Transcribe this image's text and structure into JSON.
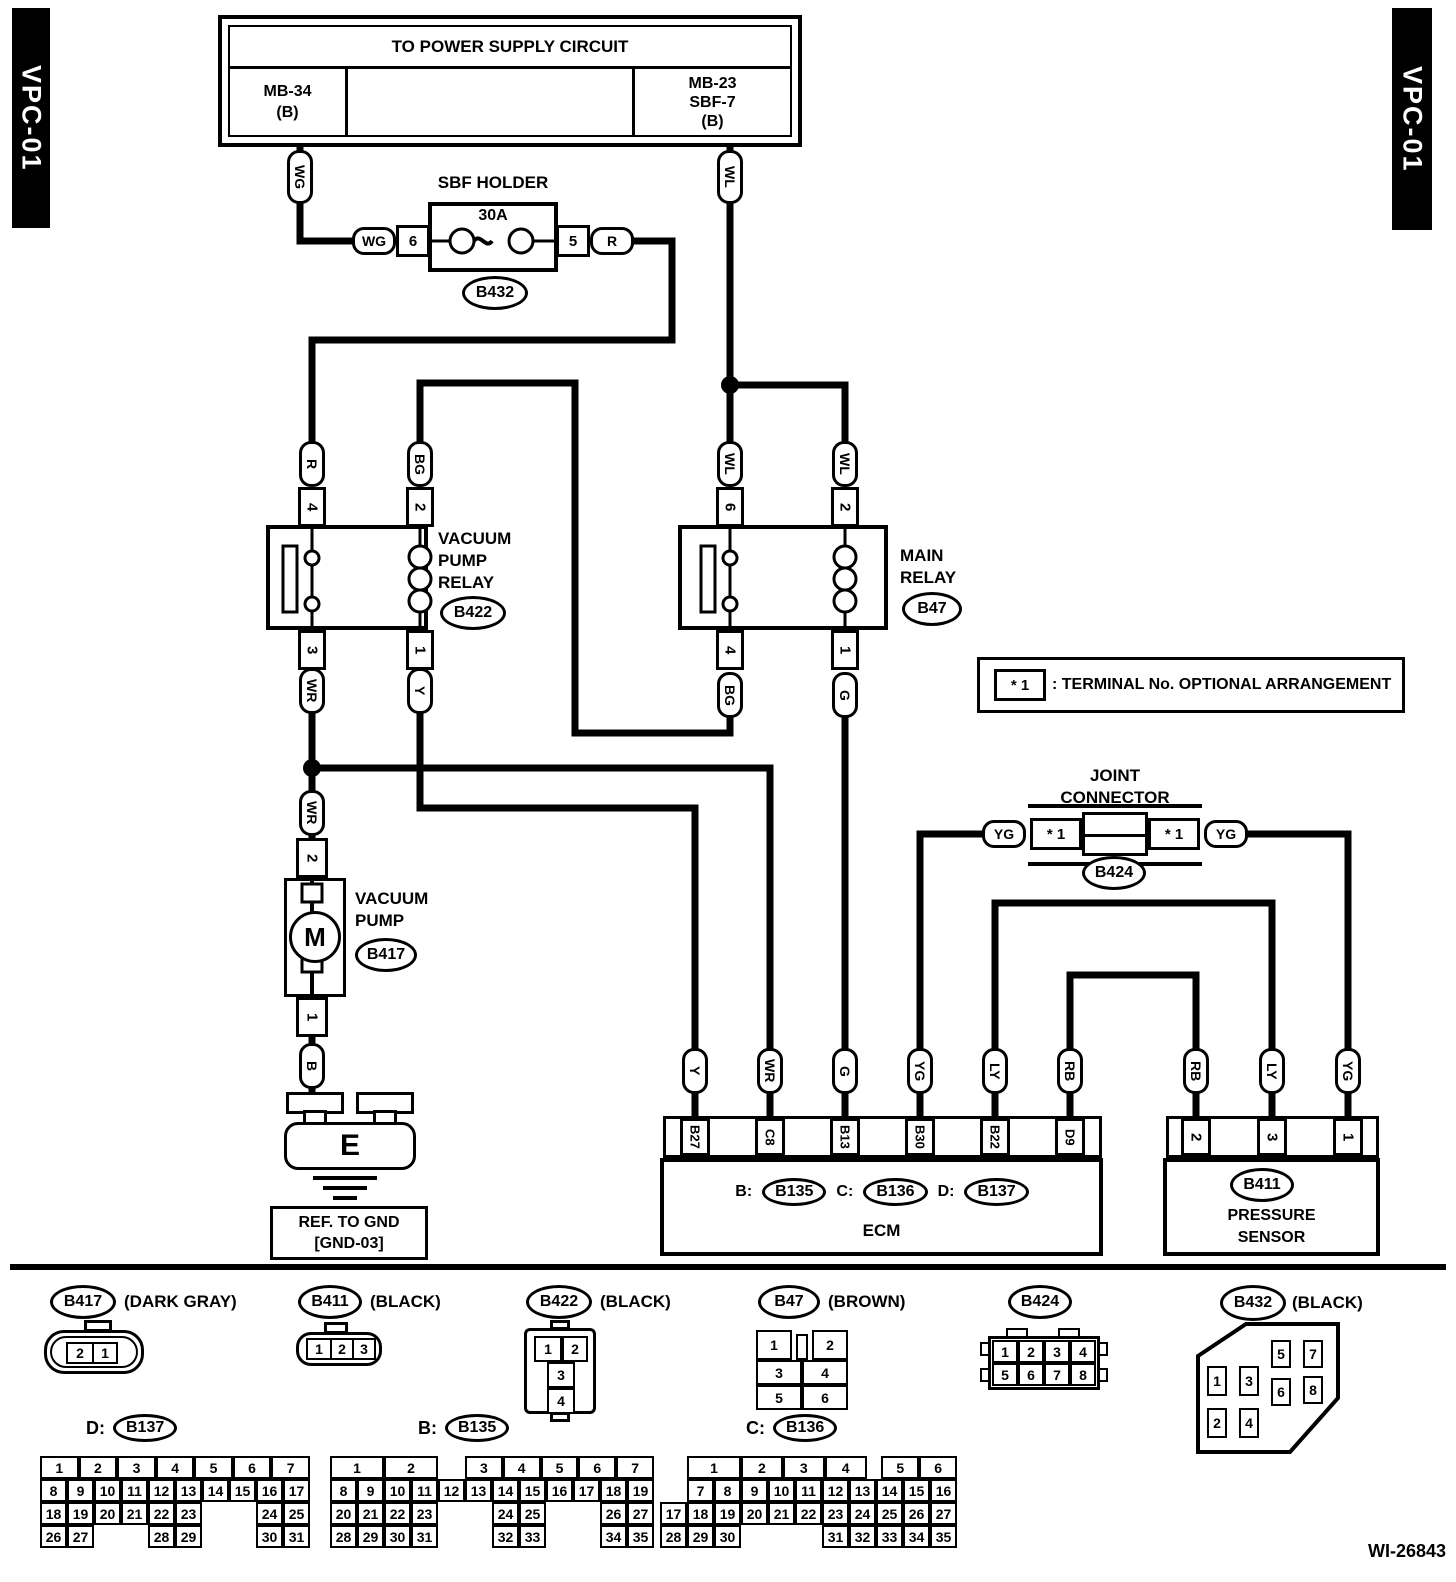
{
  "page": {
    "code_left": "VPC-01",
    "code_right": "VPC-01",
    "doc_number": "WI-26843"
  },
  "power_supply": {
    "title": "TO POWER SUPPLY CIRCUIT",
    "left_lines": [
      "MB-34",
      "(B)"
    ],
    "right_lines": [
      "MB-23",
      "SBF-7",
      "(B)"
    ]
  },
  "sbf_holder": {
    "title": "SBF HOLDER",
    "rating": "30A",
    "pin_in": "6",
    "pin_out": "5",
    "connector": "B432"
  },
  "pods": {
    "power_wg": "WG",
    "power_wl": "WL",
    "fuse_in": "WG",
    "fuse_out": "R",
    "vpr_4": "R",
    "vpr_2": "BG",
    "vpr_3": "WR",
    "vpr_1": "Y",
    "mr_6": "WL",
    "mr_2": "WL",
    "mr_4": "BG",
    "mr_1": "G",
    "pump_2": "WR",
    "pump_1": "B",
    "jc_left": "YG",
    "jc_right": "YG"
  },
  "vacuum_pump_relay": {
    "name_lines": [
      "VACUUM",
      "PUMP",
      "RELAY"
    ],
    "connector": "B422",
    "pin_tl": "4",
    "pin_tr": "2",
    "pin_bl": "3",
    "pin_br": "1"
  },
  "main_relay": {
    "name_lines": [
      "MAIN",
      "RELAY"
    ],
    "connector": "B47",
    "pin_tl": "6",
    "pin_tr": "2",
    "pin_bl": "4",
    "pin_br": "1"
  },
  "vacuum_pump": {
    "name_lines": [
      "VACUUM",
      "PUMP"
    ],
    "connector": "B417",
    "pin_top": "2",
    "pin_bottom": "1",
    "motor_label": "M"
  },
  "ground": {
    "label": "E",
    "ref_lines": [
      "REF. TO GND",
      "[GND-03]"
    ]
  },
  "note": {
    "term": "* 1",
    "text": ": TERMINAL No. OPTIONAL ARRANGEMENT"
  },
  "joint_connector": {
    "name_lines": [
      "JOINT",
      "CONNECTOR"
    ],
    "connector": "B424",
    "term_left": "* 1",
    "term_right": "* 1"
  },
  "ecm": {
    "label": "ECM",
    "connector_refs": [
      {
        "prefix": "B:",
        "id": "B135"
      },
      {
        "prefix": "C:",
        "id": "B136"
      },
      {
        "prefix": "D:",
        "id": "B137"
      }
    ],
    "terminals": [
      {
        "pin": "B27",
        "wire": "Y"
      },
      {
        "pin": "C8",
        "wire": "WR"
      },
      {
        "pin": "B13",
        "wire": "G"
      },
      {
        "pin": "B30",
        "wire": "YG"
      },
      {
        "pin": "B22",
        "wire": "LY"
      },
      {
        "pin": "D9",
        "wire": "RB"
      }
    ]
  },
  "pressure_sensor": {
    "name_lines": [
      "PRESSURE",
      "SENSOR"
    ],
    "connector": "B411",
    "terminals": [
      {
        "pin": "2",
        "wire": "RB"
      },
      {
        "pin": "3",
        "wire": "LY"
      },
      {
        "pin": "1",
        "wire": "YG"
      }
    ]
  },
  "legend": {
    "b417": {
      "id": "B417",
      "color": "(DARK GRAY)",
      "pins": [
        "2",
        "1"
      ]
    },
    "b411": {
      "id": "B411",
      "color": "(BLACK)",
      "pins": [
        "1",
        "2",
        "3"
      ]
    },
    "b422": {
      "id": "B422",
      "color": "(BLACK)",
      "pins": [
        "1",
        "2",
        "3",
        "4"
      ]
    },
    "b47": {
      "id": "B47",
      "color": "(BROWN)",
      "pins": [
        "1",
        "2",
        "3",
        "4",
        "5",
        "6"
      ]
    },
    "b424": {
      "id": "B424",
      "color": "",
      "pins": [
        "1",
        "2",
        "3",
        "4",
        "5",
        "6",
        "7",
        "8"
      ]
    },
    "b432": {
      "id": "B432",
      "color": "(BLACK)",
      "pins": [
        "1",
        "2",
        "3",
        "4",
        "5",
        "6",
        "7",
        "8"
      ]
    }
  },
  "pin_grids": [
    {
      "key": "b137",
      "prefix": "D:",
      "id": "B137",
      "header": [
        {
          "t": "1",
          "c": 0,
          "s": 1.43
        },
        {
          "t": "2",
          "c": 1.43,
          "s": 1.43
        },
        {
          "t": "3",
          "c": 2.86,
          "s": 1.43
        },
        {
          "t": "4",
          "c": 4.29,
          "s": 1.43
        },
        {
          "t": "5",
          "c": 5.71,
          "s": 1.43
        },
        {
          "t": "6",
          "c": 7.14,
          "s": 1.43
        },
        {
          "t": "7",
          "c": 8.57,
          "s": 1.43
        }
      ],
      "rows": [
        [
          "8",
          "9",
          "10",
          "11",
          "12",
          "13",
          "14",
          "15",
          "16",
          "17"
        ],
        [
          "18",
          "19",
          "20",
          "21",
          "22",
          "23",
          "",
          "",
          "24",
          "25"
        ],
        [
          "26",
          "27",
          "",
          "",
          "28",
          "29",
          "",
          "",
          "30",
          "31"
        ]
      ]
    },
    {
      "key": "b135",
      "prefix": "B:",
      "id": "B135",
      "header": [
        {
          "t": "1",
          "c": 0,
          "s": 2
        },
        {
          "t": "2",
          "c": 2,
          "s": 2
        },
        {
          "t": "3",
          "c": 5,
          "s": 1.4
        },
        {
          "t": "4",
          "c": 6.4,
          "s": 1.4
        },
        {
          "t": "5",
          "c": 7.8,
          "s": 1.4
        },
        {
          "t": "6",
          "c": 9.2,
          "s": 1.4
        },
        {
          "t": "7",
          "c": 10.6,
          "s": 1.4
        }
      ],
      "rows": [
        [
          "8",
          "9",
          "10",
          "11",
          "12",
          "13",
          "14",
          "15",
          "16",
          "17",
          "18",
          "19"
        ],
        [
          "20",
          "21",
          "22",
          "23",
          "",
          "",
          "24",
          "25",
          "",
          "",
          "26",
          "27"
        ],
        [
          "28",
          "29",
          "30",
          "31",
          "",
          "",
          "32",
          "33",
          "",
          "",
          "34",
          "35"
        ]
      ]
    },
    {
      "key": "b136",
      "prefix": "C:",
      "id": "B136",
      "header": [
        {
          "t": "1",
          "c": 1,
          "s": 2
        },
        {
          "t": "2",
          "c": 3,
          "s": 1.55
        },
        {
          "t": "3",
          "c": 4.55,
          "s": 1.55
        },
        {
          "t": "4",
          "c": 6.1,
          "s": 1.55
        },
        {
          "t": "5",
          "c": 8.2,
          "s": 1.4
        },
        {
          "t": "6",
          "c": 9.6,
          "s": 1.4
        }
      ],
      "rows": [
        [
          "",
          "7",
          "8",
          "9",
          "10",
          "11",
          "12",
          "13",
          "14",
          "15",
          "16"
        ],
        [
          "17",
          "18",
          "19",
          "20",
          "21",
          "22",
          "23",
          "24",
          "25",
          "26",
          "27"
        ],
        [
          "28",
          "29",
          "30",
          "",
          "",
          "",
          "31",
          "32",
          "33",
          "34",
          "35"
        ]
      ]
    }
  ]
}
